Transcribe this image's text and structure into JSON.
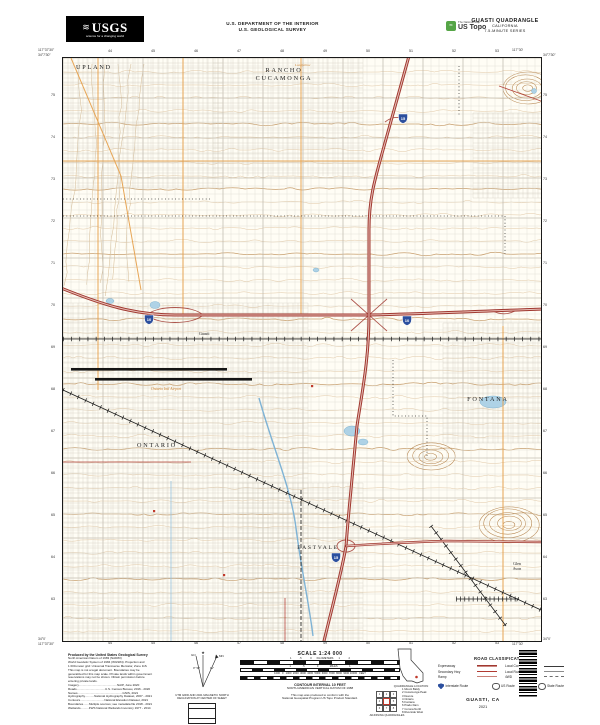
{
  "header": {
    "agency": "USGS",
    "agency_tagline": "science for a changing world",
    "dept_line1": "U.S. DEPARTMENT OF THE INTERIOR",
    "dept_line2": "U.S. GEOLOGICAL SURVEY",
    "ustopo_tagline": "The National Map",
    "ustopo_brand": "US Topo",
    "title_line1": "GUASTI QUADRANGLE",
    "title_line2": "CALIFORNIA",
    "title_line3": "7.5-MINUTE SERIES"
  },
  "map": {
    "labels": {
      "upland": "UPLAND",
      "rancho1": "RANCHO",
      "rancho2": "CUCAMONGA",
      "ontario": "ONTARIO",
      "fontana": "FONTANA",
      "eastvale": "EASTVALE",
      "guasti": "Guasti",
      "glen": "Glen",
      "avon": "Avon",
      "airport": "Ontario Intl Airport",
      "longfellow": "Longfellow"
    },
    "shields": [
      {
        "route": "10"
      },
      {
        "route": "10"
      },
      {
        "route": "15"
      },
      {
        "route": "15"
      }
    ],
    "corners": {
      "tl_lon": "117°37'30\"",
      "tl_lat": "34°7'30\"",
      "tr_lon": "117°30'",
      "tr_lat": "34°7'30\"",
      "bl_lon": "117°37'30\"",
      "bl_lat": "34°0'",
      "br_lon": "117°30'",
      "br_lat": "34°0'"
    },
    "grid_top": [
      "44",
      "45",
      "46",
      "47",
      "48",
      "49",
      "50",
      "51",
      "52",
      "53"
    ],
    "grid_left": [
      "75",
      "74",
      "73",
      "72",
      "71",
      "70",
      "69",
      "68",
      "67",
      "66",
      "65",
      "64",
      "63"
    ]
  },
  "footer": {
    "credits_head": "Produced by the United States Geological Survey",
    "credits_lines": [
      "North American Datum of 1983 (NAD83)",
      "World Geodetic System of 1984 (WGS84).  Projection and",
      "1 000-meter grid: Universal Transverse Mercator, Zone 11S",
      "This map is not a legal document. Boundaries may be",
      "generalized for this map scale. Private lands within government",
      "reservations may not be shown. Obtain permission before",
      "entering private lands.",
      " ",
      "Imagery..............................................NAIP, June 2020",
      "Roads..................................U.S. Census Bureau, 2016 - 2020",
      "Names......................................................GNIS, 2021",
      "Hydrography...........National Hydrography Dataset, 2007 - 2021",
      "Contours.............................National Elevation Dataset, 2021",
      "Boundaries.......Multiple sources; see metadata file 2018 - 2021",
      "Wetlands..........FWS National Wetlands Inventory 1977 - 2014"
    ],
    "declination": {
      "caption1": "UTM GRID AND 2021 MAGNETIC NORTH",
      "caption2": "DECLINATION AT CENTER OF SHEET",
      "gn": "GN",
      "mn": "MN",
      "gn_angle": "0° 52'",
      "mn_angle": "11°"
    },
    "scale": {
      "title": "SCALE 1:24 000",
      "km_row": "1           .5            0       KILOMETERS       1            2",
      "mi_row": "1                .5                 0                MILES                1",
      "ft_row": "1000   0   1000  2000  3000  4000  5000  6000  7000  8000  9000 10000   FEET",
      "contour_note": "CONTOUR INTERVAL 10 FEET",
      "datum_note": "NORTH AMERICAN VERTICAL DATUM OF 1988",
      "conform1": "This map was produced to conform with the",
      "conform2": "National Geospatial Program US Topo Product Standard."
    },
    "location_caption": "QUADRANGLE LOCATION",
    "adjoining": {
      "caption": "ADJOINING QUADRANGLES",
      "quads": [
        "Mount Baldy",
        "Cucamonga Peak",
        "Devore",
        "Ontario",
        "Fontana",
        "Prado Dam",
        "Corona North",
        "Riverside West"
      ]
    },
    "legend": {
      "title": "ROAD CLASSIFICATION",
      "roads": [
        {
          "label": "Expressway",
          "style": "expressway"
        },
        {
          "label": "Secondary Hwy",
          "style": "secondary"
        },
        {
          "label": "Ramp",
          "style": "ramp"
        },
        {
          "label": "Local Connector",
          "style": "connector"
        },
        {
          "label": "Local Road",
          "style": "local"
        },
        {
          "label": "4WD",
          "style": "4wd"
        }
      ],
      "shields": [
        {
          "label": "Interstate Route",
          "type": "interstate"
        },
        {
          "label": "US Route",
          "type": "us"
        },
        {
          "label": "State Route",
          "type": "state"
        }
      ]
    },
    "sheet_name": "GUASTI, CA",
    "sheet_year": "2021"
  }
}
